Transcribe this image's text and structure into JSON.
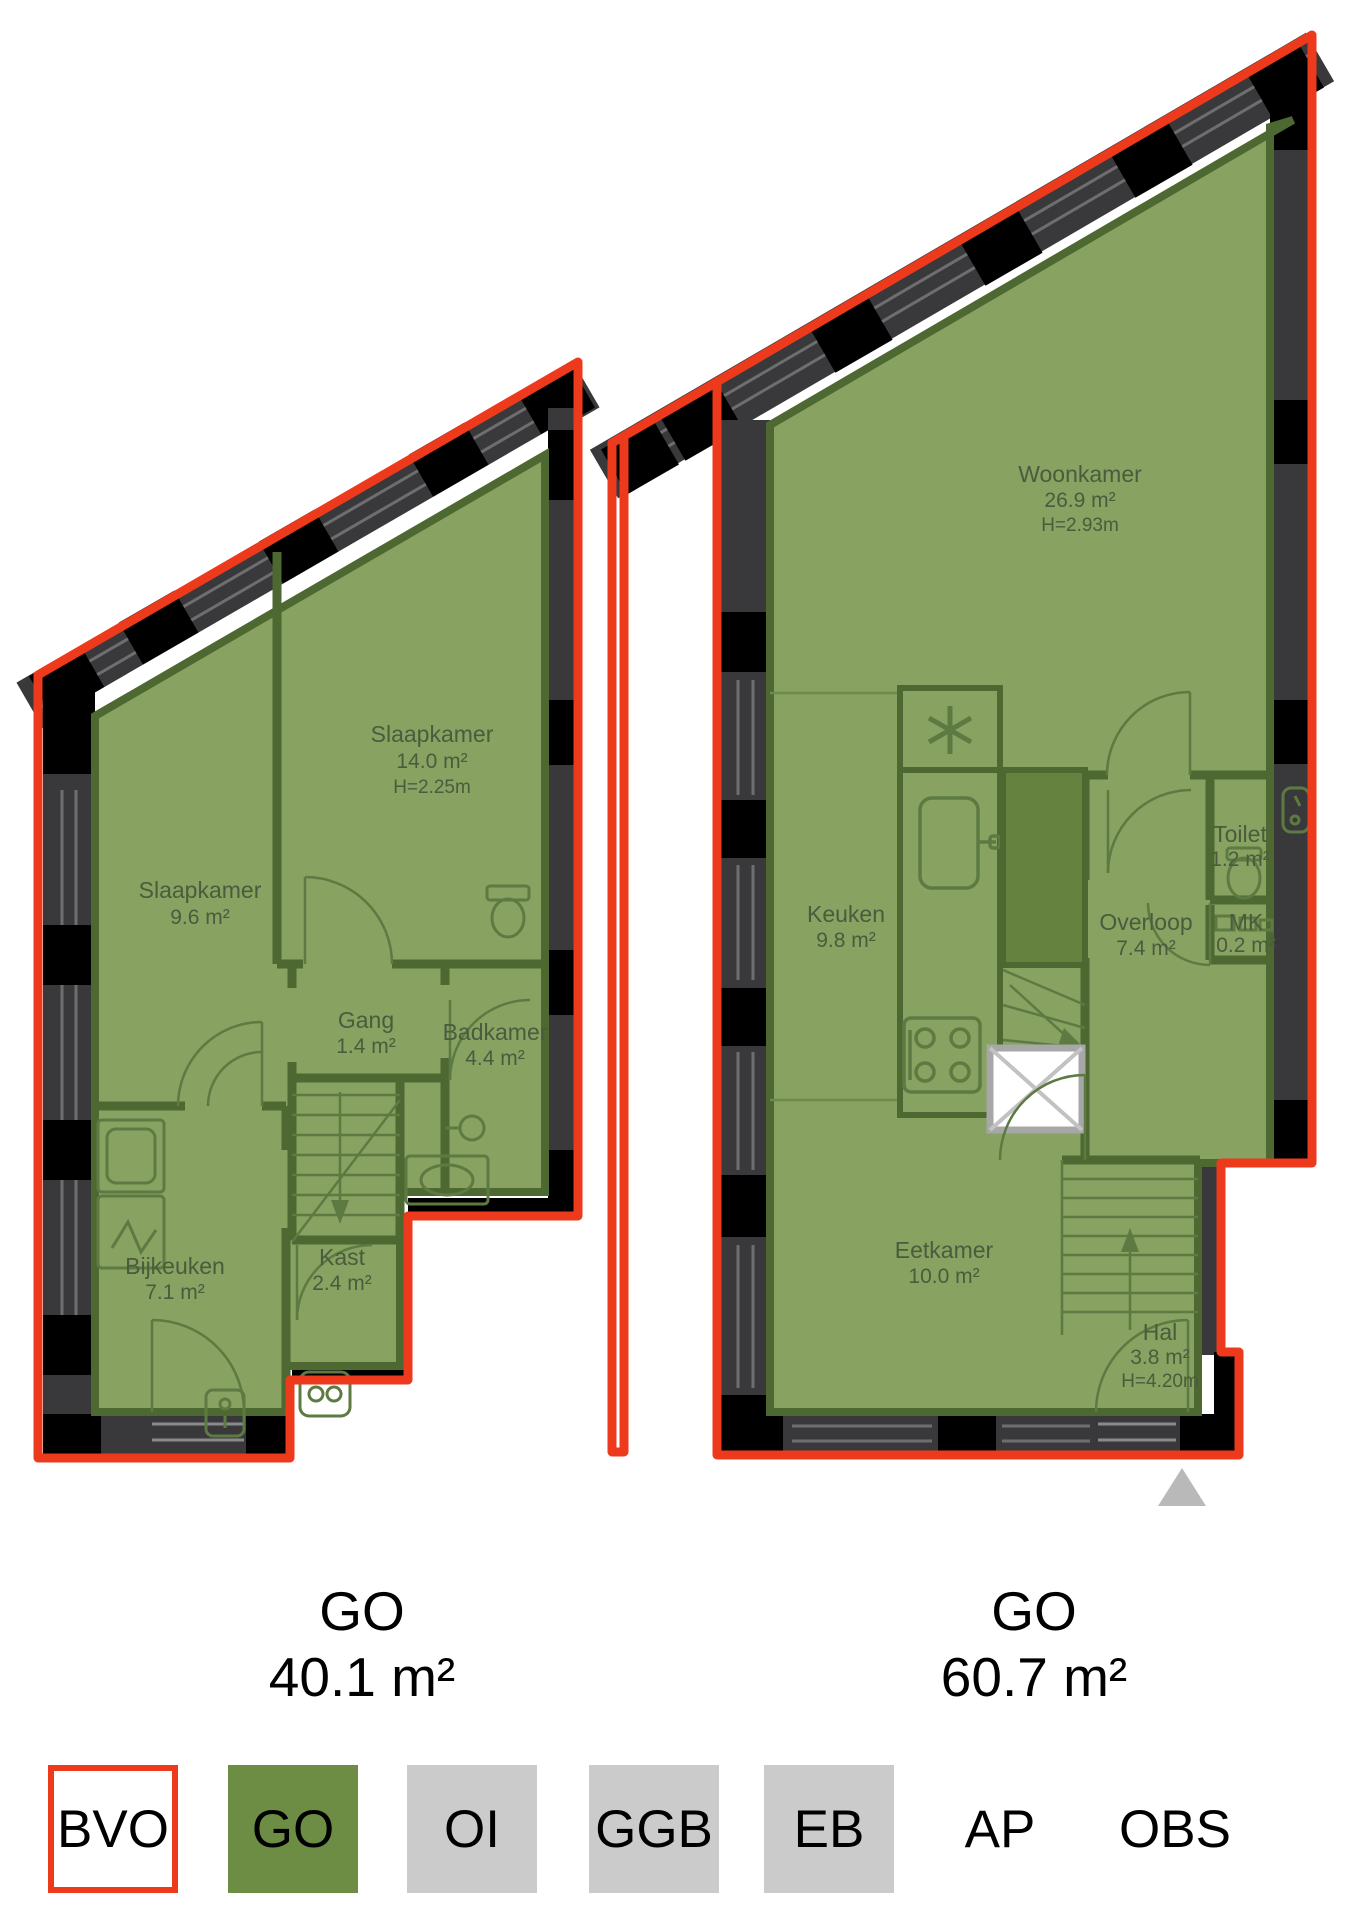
{
  "plans": [
    {
      "caption_label": "GO",
      "caption_area": "40.1 m²",
      "rooms": [
        {
          "name": "Slaapkamer",
          "area": "9.6 m²"
        },
        {
          "name": "Slaapkamer",
          "area": "14.0 m²",
          "height": "H=2.25m"
        },
        {
          "name": "Gang",
          "area": "1.4 m²"
        },
        {
          "name": "Badkamer",
          "area": "4.4 m²"
        },
        {
          "name": "Bijkeuken",
          "area": "7.1 m²"
        },
        {
          "name": "Kast",
          "area": "2.4 m²"
        }
      ]
    },
    {
      "caption_label": "GO",
      "caption_area": "60.7 m²",
      "rooms": [
        {
          "name": "Woonkamer",
          "area": "26.9 m²",
          "height": "H=2.93m"
        },
        {
          "name": "Keuken",
          "area": "9.8 m²"
        },
        {
          "name": "Toilet",
          "area": "1.2 m²"
        },
        {
          "name": "Overloop",
          "area": "7.4 m²"
        },
        {
          "name": "MK",
          "area": "0.2 m²"
        },
        {
          "name": "Eetkamer",
          "area": "10.0 m²"
        },
        {
          "name": "Hal",
          "area": "3.8 m²",
          "height": "H=4.20m"
        }
      ]
    }
  ],
  "legend": {
    "items": [
      {
        "label": "BVO"
      },
      {
        "label": "GO"
      },
      {
        "label": "OI"
      },
      {
        "label": "GGB"
      },
      {
        "label": "EB"
      },
      {
        "label": "AP"
      },
      {
        "label": "OBS"
      }
    ]
  },
  "colors": {
    "bvo_outline": "#ee3a1c",
    "go_fill": "#87a261",
    "wall_dark": "#39393b",
    "legend_go": "#6d8d44",
    "legend_gray": "#cbcbcb"
  }
}
